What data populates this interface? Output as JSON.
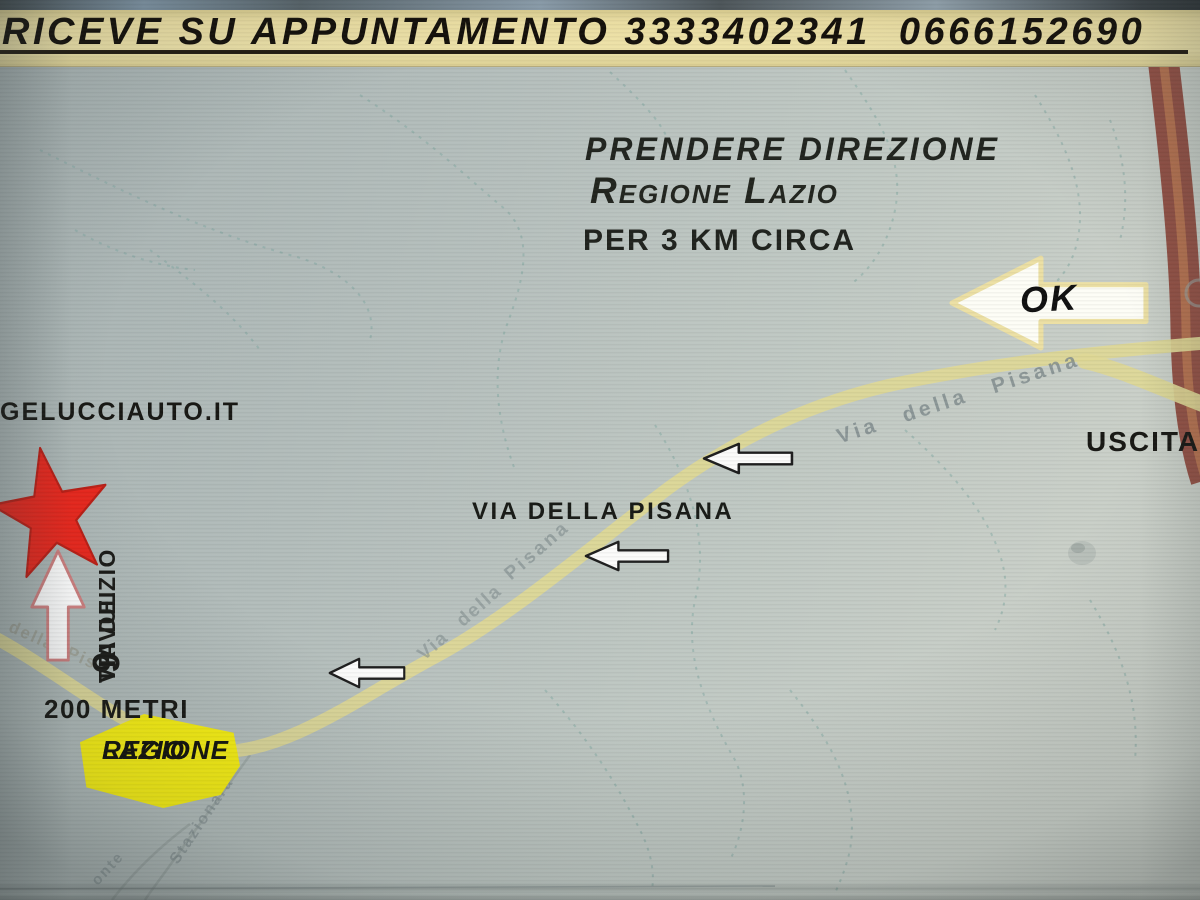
{
  "banner": {
    "text": "RICEVE SU APPUNTAMENTO 3333402341  0666152690"
  },
  "directions": {
    "line1": "PRENDERE DIREZIONE",
    "line2": "Regione Lazio",
    "line3": "PER 3 KM CIRCA"
  },
  "destination": {
    "website": "GELUCCIAUTO.IT",
    "street_line1": "VIA DEI",
    "street_line2": "TRIVULZIO",
    "street_number": "9",
    "distance": "200 METRI"
  },
  "road": {
    "main_label": "VIA DELLA PISANA",
    "exit_label": "USCITA",
    "ok_label": "OK"
  },
  "badge": {
    "line1": "REGIONE",
    "line2": "LAZIO"
  },
  "map_labels": {
    "upper": "Via della Pisana",
    "mid": "Pisana",
    "mid2": "Via della",
    "lower": "della Pisa",
    "side1": "Stazionara",
    "side2": "onte"
  },
  "colors": {
    "banner_bg": "#ecdfa3",
    "map_bg": "#bcc5c2",
    "road": "#ded896",
    "highway": "#8d4336",
    "highway_core": "#bf7a52",
    "badge_bg": "#f7ef12",
    "star": "#e8271d",
    "dashed_path": "#7ba39e"
  }
}
